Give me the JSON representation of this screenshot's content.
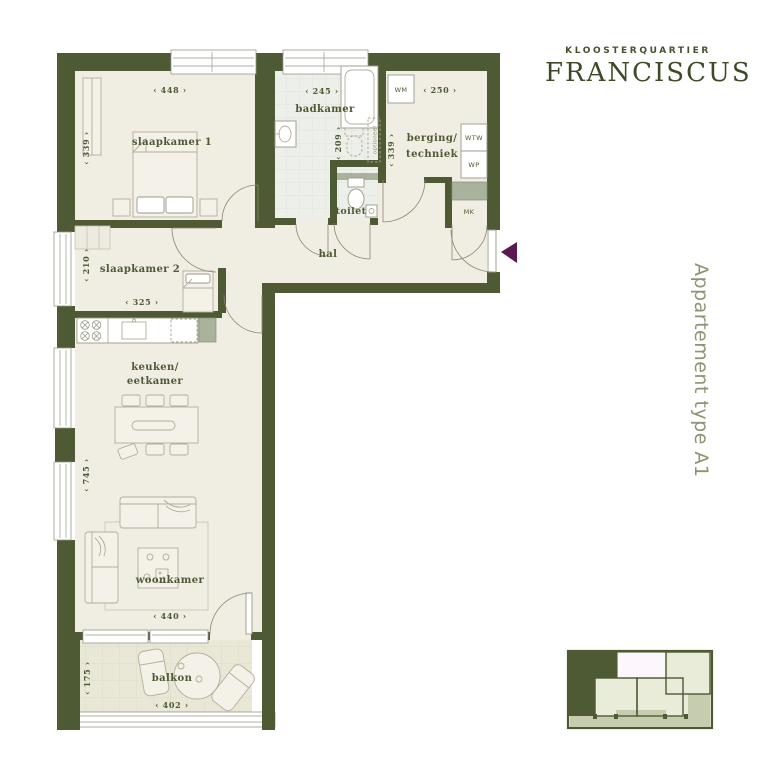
{
  "brand": {
    "kicker": "KLOOSTERQUARTIER",
    "name": "FRANCISCUS"
  },
  "side_label": "Appartement type A1",
  "rooms": {
    "slaapkamer1": {
      "label": "slaapkamer 1",
      "width": "‹ 448 ›",
      "depth": "‹ 339 ›"
    },
    "slaapkamer2": {
      "label": "slaapkamer 2",
      "width": "‹ 325 ›",
      "depth": "‹ 210 ›"
    },
    "badkamer": {
      "label": "badkamer",
      "width": "‹ 245 ›",
      "depth": "‹ 209 ›"
    },
    "berging": {
      "label_line1": "berging/",
      "label_line2": "techniek",
      "width": "‹ 250 ›",
      "depth": "‹ 339 ›"
    },
    "toilet": {
      "label": "toilet"
    },
    "hal": {
      "label": "hal"
    },
    "keuken": {
      "label_line1": "keuken/",
      "label_line2": "eetkamer",
      "depth": "‹ 745 ›"
    },
    "woonkamer": {
      "label": "woonkamer",
      "width": "‹ 440 ›"
    },
    "balkon": {
      "label": "balkon",
      "width": "‹ 402 ›",
      "depth": "‹ 175 ›"
    }
  },
  "appliances": {
    "wm": "WM",
    "wtw": "WTW",
    "wp": "WP",
    "mk": "MK",
    "optional_note": "optioneel"
  },
  "colors": {
    "wall": "#4e5a33",
    "floor": "#f0ede3",
    "bath_tile": "#edf0ea",
    "balcony_tile": "#e9e8d6",
    "sage_fixture": "#a9b29b",
    "label_text": "#4e5a33",
    "side_label_text": "#8d9472",
    "entrance_arrow": "#5a1a50",
    "minimap_room": "#e9ecd9",
    "minimap_highlight_unit": "#4e5a33",
    "minimap_core": "#fdf6fd",
    "minimap_balcony_strip": "#c5cdae"
  }
}
